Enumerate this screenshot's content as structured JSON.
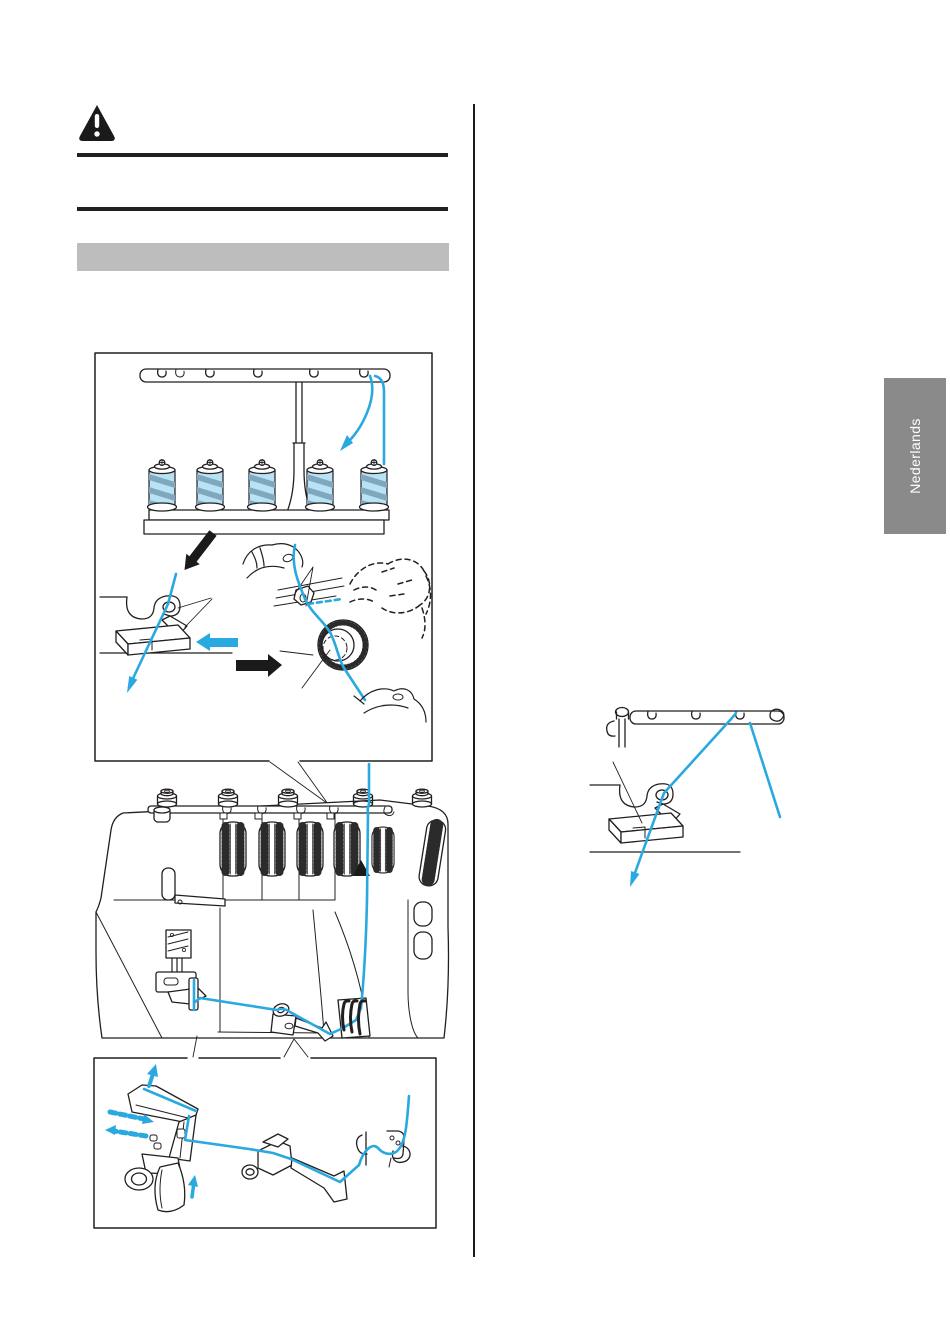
{
  "page": {
    "language_tab": {
      "label": "Nederlands"
    },
    "icons": {
      "warning": "warning-triangle-icon",
      "position_marker": "up-triangle-marker"
    },
    "colors": {
      "thread_blue": "#2aa9e0",
      "line_black": "#231f20",
      "heading_bar_gray": "#bdbdbd",
      "language_tab_gray": "#8a8a8a",
      "spool_thread_fill": "#b9e2f4",
      "spool_thread_stripe": "#7fa8bf",
      "warning_black": "#1a1a1a"
    }
  }
}
